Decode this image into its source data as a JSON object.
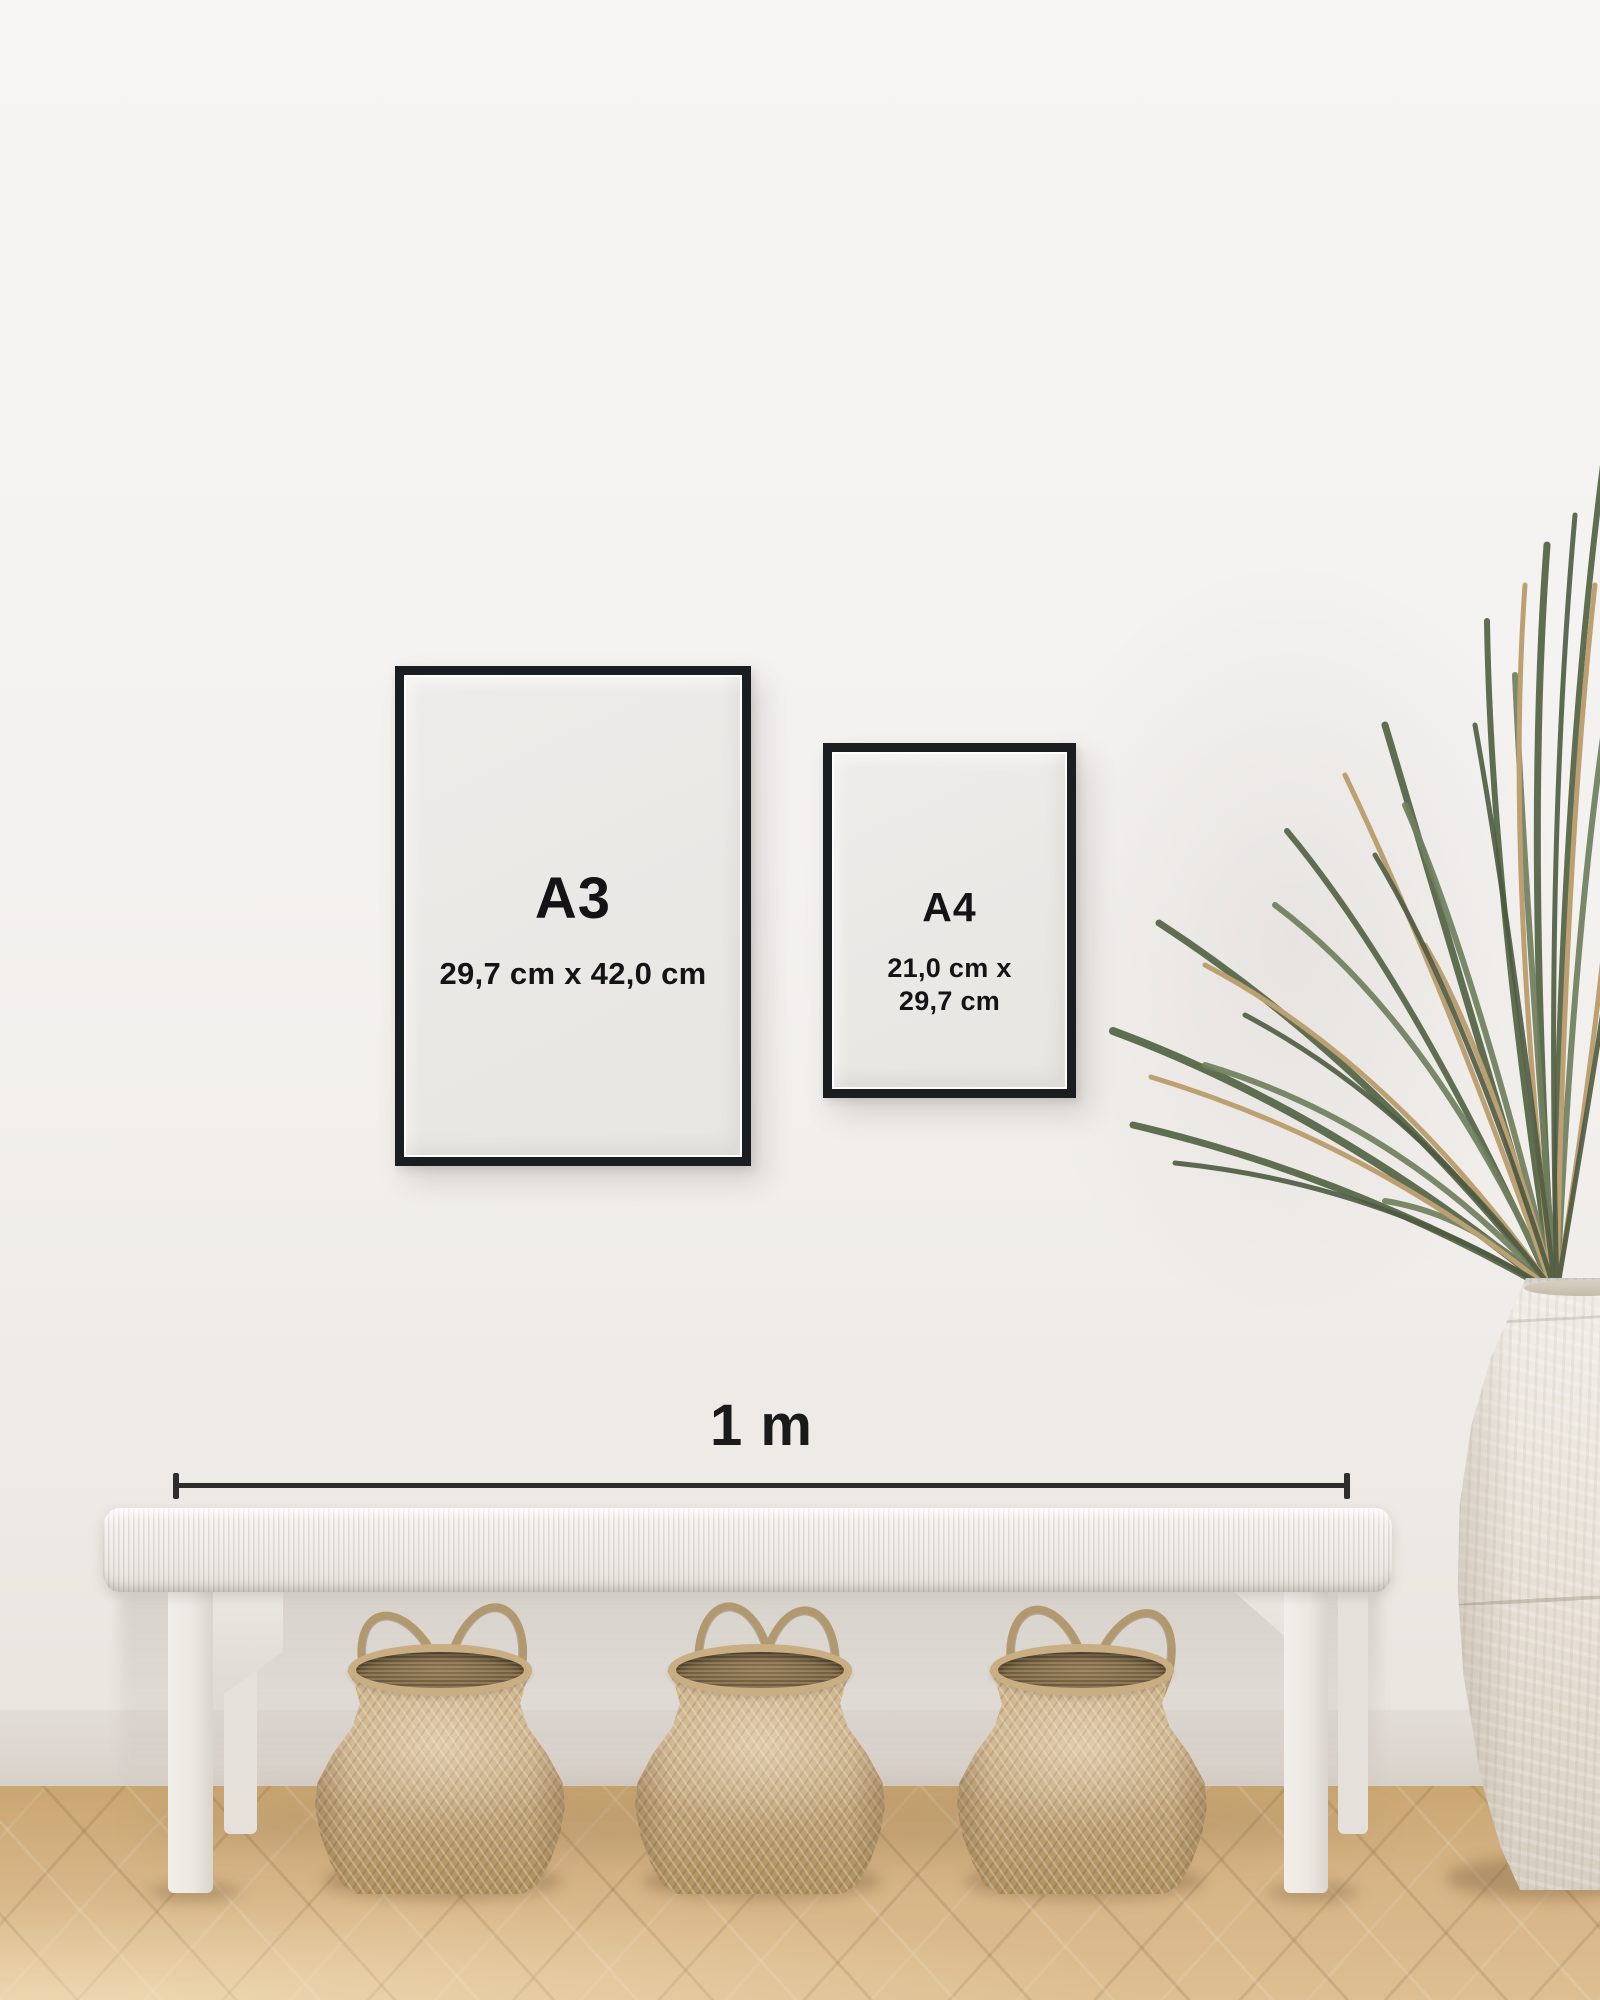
{
  "frames": [
    {
      "label": "A3",
      "size_lines": [
        "29,7 cm x 42,0 cm"
      ]
    },
    {
      "label": "A4",
      "size_lines": [
        "21,0 cm x",
        "29,7 cm"
      ]
    }
  ],
  "scale_bar": {
    "label": "1 m"
  },
  "colors": {
    "frame_black": "#1b1e21",
    "poster_paper": "#e9e7e4",
    "text": "#141417",
    "scale_line": "#2d2d2d",
    "wall_top": "#f6f5f3",
    "wall_bottom": "#eae5df",
    "skirting": "#dedad4",
    "floor_light": "#ddbf92",
    "floor_dark": "#c9a672",
    "bench_white": "#f2efeb",
    "basket_weave": "#c4a87e",
    "basket_interior": "#6b583a",
    "plant_green": "#5f6e50",
    "plant_dry": "#bda072",
    "vase_ceramic": "#e8e2d9"
  }
}
